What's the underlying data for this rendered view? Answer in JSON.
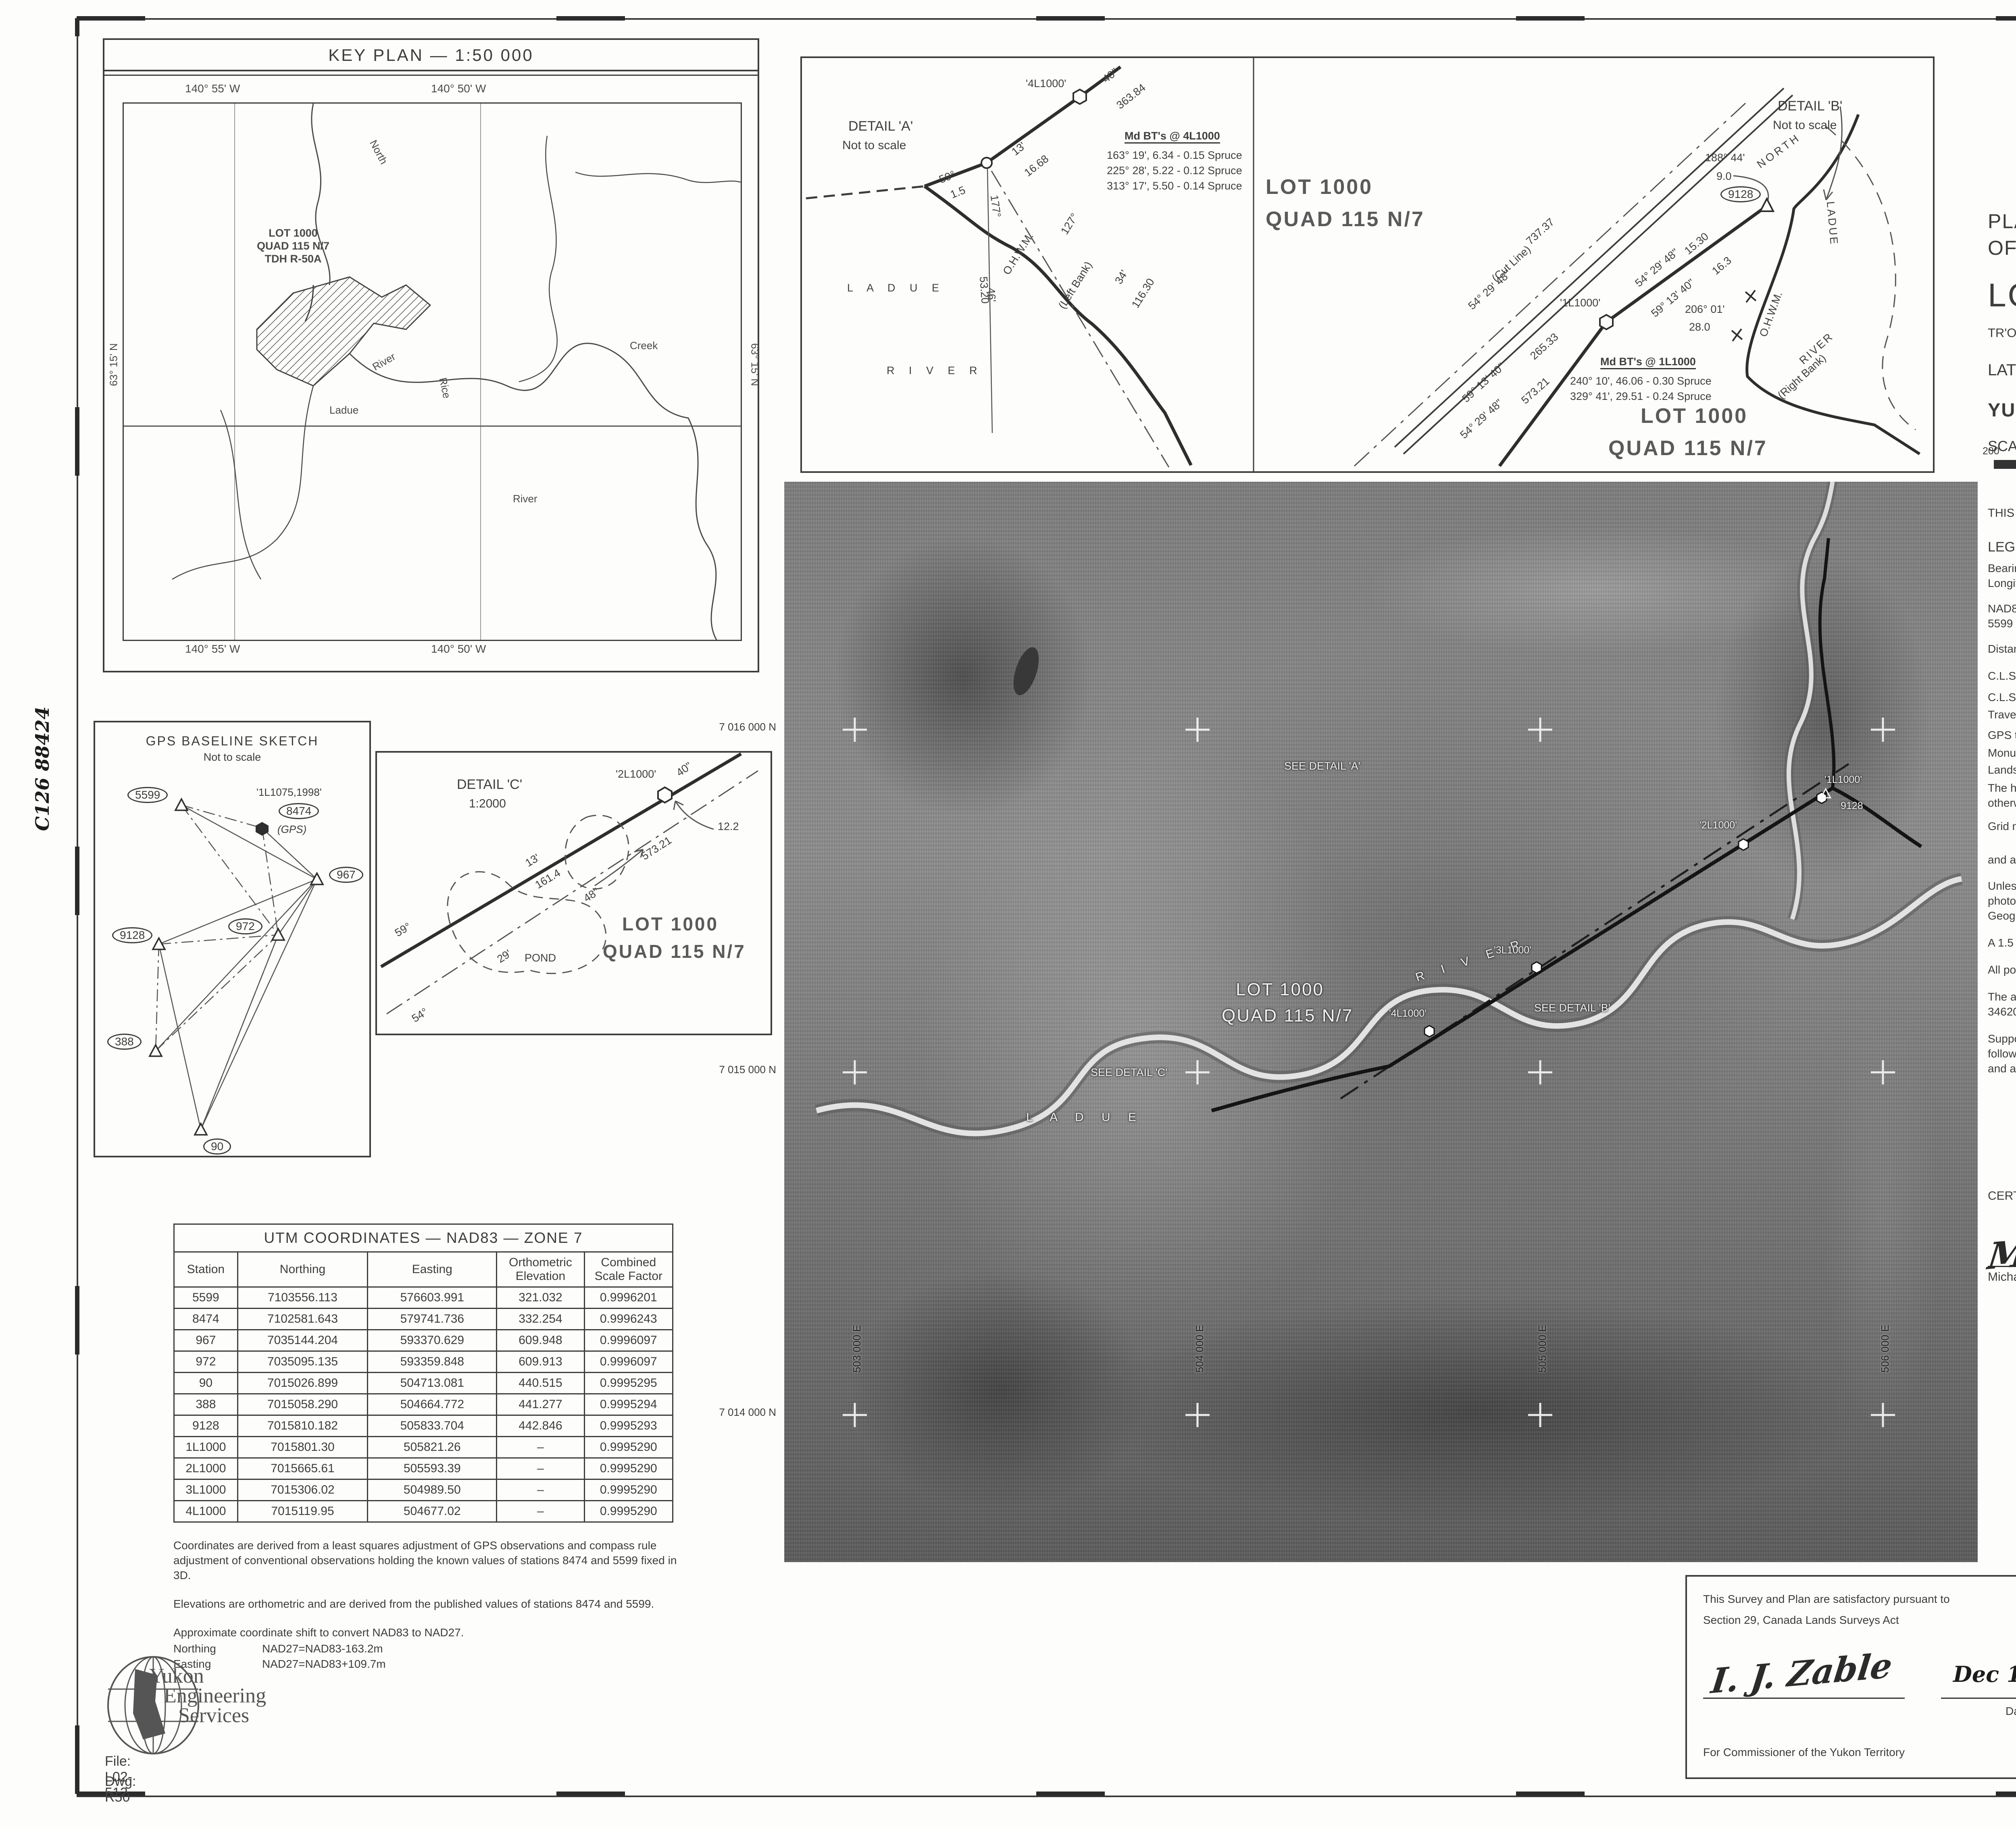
{
  "stamps": {
    "clsr": {
      "title": "CANADA LANDS SURVEYS RECORDS",
      "number": "88424",
      "date_label": "Date:",
      "date_value": "May 10",
      "year_print": ", 200",
      "year_hand": "4"
    },
    "land_titles": {
      "line1": "A copy of this plan is filed in the Land",
      "line2": "Titles Office at Whitehorse, Yukon as",
      "number": "2004-0136",
      "lto": "LTO",
      "on_label": "on",
      "date_value": "07 Sept.",
      "year_print": "200",
      "year_hand": "4",
      "at_label": "at",
      "time_value": "13:41",
      "signature": "O.Deli",
      "registrar": "Registrar"
    }
  },
  "title_block": {
    "line1": "PLAN AND FIELD NOTES",
    "line2": "OF SURVEY OF",
    "lot_title": "LOT 1000, QUAD 115 N/7",
    "subtitle": "TR'ONDEK HWECH'IN SETTLEMENT LAND SELECTION R-50A",
    "latlong": "LATITUDE 63° 16', LONGITUDE 140° 54' (APPROX.)",
    "territory": "YUKON TERRITORY",
    "scale": "SCALE  1 : 10 000",
    "scalebar_labels": [
      "200",
      "100",
      "0",
      "200",
      "400",
      "600",
      "800",
      "1000 metres"
    ],
    "executed": "THIS SURVEY WAS EXECUTED ON JULY 13 AND SEPTEMBER 16, 2002, BY MICHAEL T. KEARNEY, C.L.S.",
    "legend_title": "LEGEND :",
    "legend_intro1": "Bearings are UTM Grid, derived from GPS baselines and are referred to the central meridian of UTM Zone 7 (141° West Longitude) NAD83.",
    "legend_intro2": "NAD83 UTM coordinates (Zone 7) and orthometric elevations were derived from control stations 8474 (F.B. 34450 CLSR) and 5599 (F.B. 34280 CLSR).",
    "legend_intro3": "Distances shown are horizontal at general ground level and are expressed in metres.",
    "legend_items": [
      {
        "label": "C.L.S. 77 Post found shown thus",
        "symbol": "hex-filled"
      },
      {
        "label": "C.L.S. 77 Post placed shown thus",
        "symbol": "hex-open"
      },
      {
        "label": "Traverse lines and stations shown thus",
        "symbol": "traverse-line"
      },
      {
        "label": "GPS traverse stations shown thus",
        "symbol": "triangle"
      },
      {
        "label": "Monuments occupied by GPS suffixed thus",
        "symbol": "gps-suffix",
        "symbol_text": "(GPS)"
      },
      {
        "label": "Lands dealt with by this plan bounded thus",
        "symbol": "heavy-line"
      }
    ],
    "note_heavy": "The heavy line depicting the natural boundaries shown on the orthophoto is offset to the upland side of the O.H.W.M., otherwise it is centered on the boundary.",
    "note_grid1": "Grid marks are referred to NAD83 UTM coordinates",
    "note_grid2": "and are shown thus",
    "notes": [
      "Unless shown otherwise on the body of the plan, the O.H.W.M. of the natural boundaries have been determined by photogrammetric methods using 1:50,000 aerial photographs, numbers 104 and 105 roll number A28345 (N.A.P.L.) taken by Geographic Air Survey LTD., Edmonton Alberta, July 1999. The orthophoto was produced by The Orthoshop, Calgary, Alberta.",
      "A 1.5 metre iron marker post and plaque were placed 0.3m from each monument placed.",
      "All posts placed in this survey have been marked with the year 2002 and a unique number as shown on the plan.",
      "The airborne GPS and aerial triangulation results for the aerial photography used for this survey are recorded under F.B. 34620 CLSR.",
      "Support information is contained in supplementary field notes recorded under F.B. 34917 C.L.S.R. which includes the following information: Surveyors report, GPS report showing the results of the least squares adjustment of the control network and a copy of the survey instructions."
    ]
  },
  "certification": {
    "certified": "CERTIFIED CORRECT : Re: Canada Lands Surveys Act",
    "surveyor_sig": "M Kearney",
    "surveyor_name": "Michael T. Kearney C.L.S.",
    "cert_date": "Feb 11, 2003",
    "date_label": "Date",
    "seal_top": "ASSOCIATION OF CANADA LANDS SURVEYORS",
    "seal_name": "MICHAEL T. KEARNEY",
    "seal_comm": "COMM. No. 1568",
    "seal_bottom": "ASSOCIATION DES ARPENTEURS DES TERRES DU CANADA"
  },
  "trondek_box": {
    "title": "Tr'ondëk Hwëch'in",
    "place_hand": "Whitehorse",
    "place_suffix": ", Yukon",
    "date_hand": "Dec 15",
    "year_hand": "2003",
    "body1": "This survey and plan are satisfactory Re: Section 29, Canada Lands Surveys Act,",
    "body2": "and",
    "body3": "APPROVED Re: Section 15.6.6, Tr'ondëk Hwëch'in Final Agreement, Yukon First Nations Land Claims Settlement Act.",
    "role": "CHIEF"
  },
  "commissioner_box": {
    "line1": "This Survey and Plan are satisfactory pursuant to",
    "line2": "Section 29, Canada Lands Surveys Act",
    "sig": "I. J. Zable",
    "date_hand": "Dec 17 / 2003",
    "date_label": "Date  /",
    "for_label": "For Commissioner of the Yukon Territory"
  },
  "dnr_box": {
    "title": "Department of Natural Resources",
    "re1": "Re: Section 29, Canada Lands Surveys Act.",
    "re2": "Section 15.2.1, Tr'ondëk Hwëch'in Final Agreement, Yukon",
    "re3": "First Nations Land Claims Settlement Act.",
    "confirmed_label": "CONFIRMED:",
    "confirmed_date": "May 10",
    "confirmed_year": "2004",
    "sig": "Brian Thompson",
    "name": "Brian Thompson, Head, Cadastral Services",
    "division": "Yukon Territory, Legal Surveys Division"
  },
  "bottom_strip": {
    "file_label": "File:",
    "file": "SM8454-115N/7",
    "examined_label": "Examined:",
    "examined_sig": "DB",
    "reviewed_label": "Reviewed:",
    "reviewed_sig": "DH",
    "item_label": "Item:",
    "item": "FI-02 YT",
    "date1_label": "Date:",
    "date1": "Jan.6/03",
    "date2_label": "Date:",
    "date2": "Mar.27/03"
  },
  "firm": {
    "name1": "Yukon",
    "name2": "Engineering",
    "name3": "Services",
    "file": "File: L02-512",
    "dwg": "Dwg: R50"
  },
  "key_plan": {
    "title": "KEY PLAN  —  1:50 000",
    "top_left_long": "140° 55' W",
    "top_right_long": "140° 50' W",
    "bottom_left_long": "140° 55' W",
    "bottom_right_long": "140° 50' W",
    "lat_left": "63° 15' N",
    "lat_right": "63° 15' N",
    "lot_label1": "LOT 1000",
    "lot_label2": "QUAD 115 N/7",
    "lot_label3": "TDH R-50A",
    "labels": {
      "north": "North",
      "ladue": "Ladue",
      "river_upper": "River",
      "river_lower": "River",
      "rice": "Rice",
      "creek": "Creek"
    }
  },
  "detail_a": {
    "title": "DETAIL 'A'",
    "scale": "Not to scale",
    "station": "'4L1000'",
    "post_angle": "40\"",
    "post_dist": "363.84",
    "bt_title": "Md BT's @ 4L1000",
    "bts": [
      "163° 19', 6.34 - 0.15 Spruce",
      "225° 28', 5.22 - 0.12 Spruce",
      "313° 17', 5.50 - 0.14 Spruce"
    ],
    "d13": "13'",
    "d1668": "16.68",
    "d59": "59°",
    "d15": "1.5",
    "d177": "177°",
    "d127": "127°",
    "d46": "46'",
    "d5320": "53.20",
    "d34": "34'",
    "d11630": "116.30",
    "ohwm": "O.H.W.M.",
    "bank": "(Left Bank)",
    "ladue": "L A D U E",
    "river": "R I V E R",
    "lot1": "LOT 1000",
    "lot2": "QUAD 115 N/7"
  },
  "detail_b": {
    "title": "DETAIL 'B'",
    "scale": "Not to scale",
    "north": "NORTH",
    "ladue": "LADUE",
    "river": "RIVER",
    "bank": "(Right Bank)",
    "ohwm": "O.H.W.M.",
    "station_9128": "9128",
    "ang18844": "188° 44'",
    "d90": "9.0",
    "cut_bearing": "54° 29' 48\"",
    "cut_dist": "737.37",
    "cut_line": "(Cut Line)",
    "b1530_bearing": "54° 29' 48\"",
    "b1530": "15.30",
    "b163_bearing": "59° 13' 40\"",
    "b163": "16.3",
    "station_1l1000": "'1L1000'",
    "ang20601": "206° 01'",
    "d280": "28.0",
    "b26533": "265.33",
    "b26533_bearing": "59° 13' 40\"",
    "b57321": "573.21",
    "b57321_bearing": "54° 29' 48\"",
    "bt_title": "Md BT's @ 1L1000",
    "bts": [
      "240° 10', 46.06 - 0.30 Spruce",
      "329° 41', 29.51 - 0.24 Spruce"
    ],
    "lot1": "LOT 1000",
    "lot2": "QUAD 115 N/7"
  },
  "detail_c": {
    "title": "DETAIL 'C'",
    "scale": "1:2000",
    "station": "'2L1000'",
    "ang40": "40\"",
    "d122": "12.2",
    "d13": "13'",
    "d1614": "161.4",
    "d59": "59°",
    "d57321": "573.21",
    "d48": "48\"",
    "d29": "29'",
    "pond": "POND",
    "d54": "54°",
    "lot1": "LOT 1000",
    "lot2": "QUAD 115 N/7"
  },
  "gps_sketch": {
    "title": "GPS BASELINE SKETCH",
    "subtitle": "Not to scale",
    "station_note": "'1L1075,1998'",
    "gps_suffix": "(GPS)",
    "stations": [
      {
        "label": "5599"
      },
      {
        "label": "8474"
      },
      {
        "label": "967"
      },
      {
        "label": "972"
      },
      {
        "label": "9128"
      },
      {
        "label": "388"
      },
      {
        "label": "90"
      }
    ]
  },
  "photo": {
    "northings": [
      "7 016 000 N",
      "7 015 000 N",
      "7 014 000 N"
    ],
    "eastings": [
      "503 000 E",
      "504 000 E",
      "505 000 E",
      "506 000 E"
    ],
    "lot1": "LOT 1000",
    "lot2": "QUAD 115 N/7",
    "see_a": "SEE DETAIL 'A'",
    "see_b": "SEE DETAIL 'B'",
    "see_c": "SEE DETAIL 'C'",
    "ladue": "L A D U E",
    "river": "R I V E R",
    "s1": "'1L1000'",
    "s2": "'2L1000'",
    "s3": "'3L1000'",
    "s4": "'4L1000'",
    "s9128": "9128"
  },
  "side_notes": {
    "left": "C126  88424",
    "right": "C126  88424"
  },
  "utm_table": {
    "title": "UTM COORDINATES — NAD83 — ZONE 7",
    "columns": [
      "Station",
      "Northing",
      "Easting",
      "Orthometric Elevation",
      "Combined Scale Factor"
    ],
    "rows": [
      [
        "5599",
        "7103556.113",
        "576603.991",
        "321.032",
        "0.9996201"
      ],
      [
        "8474",
        "7102581.643",
        "579741.736",
        "332.254",
        "0.9996243"
      ],
      [
        "967",
        "7035144.204",
        "593370.629",
        "609.948",
        "0.9996097"
      ],
      [
        "972",
        "7035095.135",
        "593359.848",
        "609.913",
        "0.9996097"
      ],
      [
        "90",
        "7015026.899",
        "504713.081",
        "440.515",
        "0.9995295"
      ],
      [
        "388",
        "7015058.290",
        "504664.772",
        "441.277",
        "0.9995294"
      ],
      [
        "9128",
        "7015810.182",
        "505833.704",
        "442.846",
        "0.9995293"
      ],
      [
        "1L1000",
        "7015801.30",
        "505821.26",
        "–",
        "0.9995290"
      ],
      [
        "2L1000",
        "7015665.61",
        "505593.39",
        "–",
        "0.9995290"
      ],
      [
        "3L1000",
        "7015306.02",
        "504989.50",
        "–",
        "0.9995290"
      ],
      [
        "4L1000",
        "7015119.95",
        "504677.02",
        "–",
        "0.9995290"
      ]
    ],
    "notes": [
      "Coordinates are derived from a least squares adjustment of GPS observations and compass rule adjustment of conventional observations holding the known values of stations 8474 and 5599 fixed in 3D.",
      "Elevations are orthometric and are derived from the published values of stations 8474 and 5599.",
      "Approximate coordinate shift to convert NAD83 to NAD27."
    ],
    "shift_rows": [
      [
        "Northing",
        "NAD27=NAD83-163.2m"
      ],
      [
        "Easting",
        "NAD27=NAD83+109.7m"
      ]
    ]
  }
}
